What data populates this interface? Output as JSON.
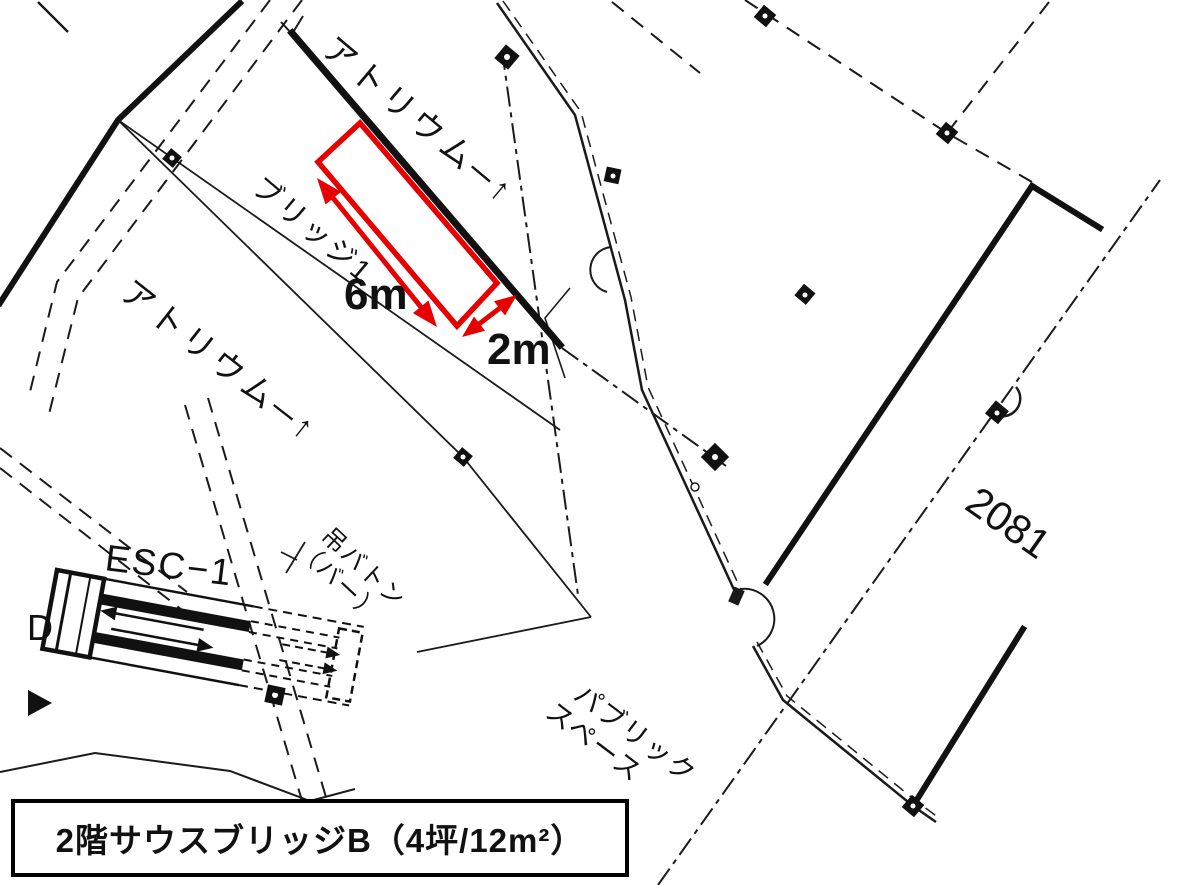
{
  "colors": {
    "background": "#ffffff",
    "line": "#1a1a1a",
    "highlight": "#e60000"
  },
  "plan": {
    "labels": {
      "atrium_top": "アトリウム─↑",
      "atrium_left": "アトリウム─↑",
      "bridge": "ブリッジ1",
      "escalator": "ESC−1",
      "batten_line1": "吊バトン",
      "batten_line2": "（バー）",
      "public_line1": "パブリック",
      "public_line2": "スペース",
      "room_number": "2081",
      "grid_letter": "D"
    },
    "dimensions": {
      "length": "6m",
      "width": "2m"
    },
    "caption": "2階サウスブリッジB（4坪/12m²）"
  }
}
